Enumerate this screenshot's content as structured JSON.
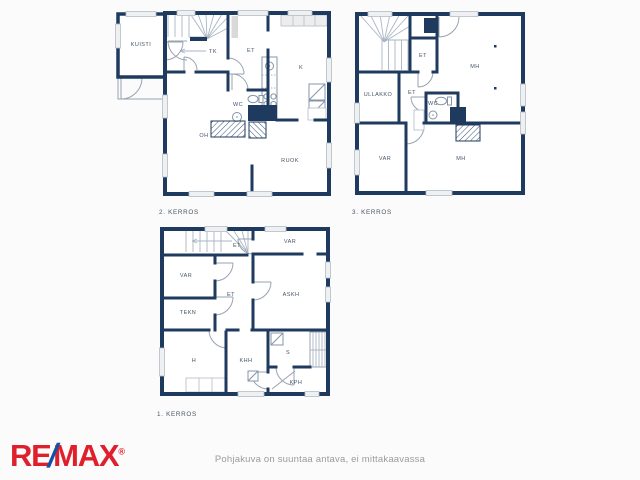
{
  "page": {
    "disclaimer": "Pohjakuva on suuntaa antava, ei mittakaavassa"
  },
  "logo": {
    "re": "RE",
    "slash": "/",
    "max": "MAX",
    "registered": "®"
  },
  "colors": {
    "background": "#fbfbfb",
    "wall": "#1e3a5e",
    "room_fill": "#ffffff",
    "door_line": "#97a3b3",
    "stair_line": "#aab6c4",
    "window_fill": "#eef0f1",
    "label_text": "#455468",
    "logo_red": "#e01f2d",
    "logo_blue": "#1252a5",
    "disclaimer_text": "#9b9b9b"
  },
  "floors": {
    "second": {
      "label": "2. KERROS",
      "rooms": {
        "kuisti": "KUISTI",
        "tk": "TK",
        "et": "ET",
        "k": "K",
        "wc": "WC",
        "oh": "OH",
        "ruok": "RUOK"
      }
    },
    "third": {
      "label": "3. KERROS",
      "rooms": {
        "et_hall": "ET",
        "ullakko": "ULLAKKO",
        "et": "ET",
        "wc": "WC",
        "mh_top": "MH",
        "var": "VAR",
        "mh_bottom": "MH"
      }
    },
    "first": {
      "label": "1. KERROS",
      "rooms": {
        "et_top": "ET",
        "var_top": "VAR",
        "var": "VAR",
        "tekn": "TEKN",
        "et": "ET",
        "askh": "ASKH",
        "h": "H",
        "khh": "KHH",
        "s": "S",
        "kph": "KPH"
      }
    }
  }
}
